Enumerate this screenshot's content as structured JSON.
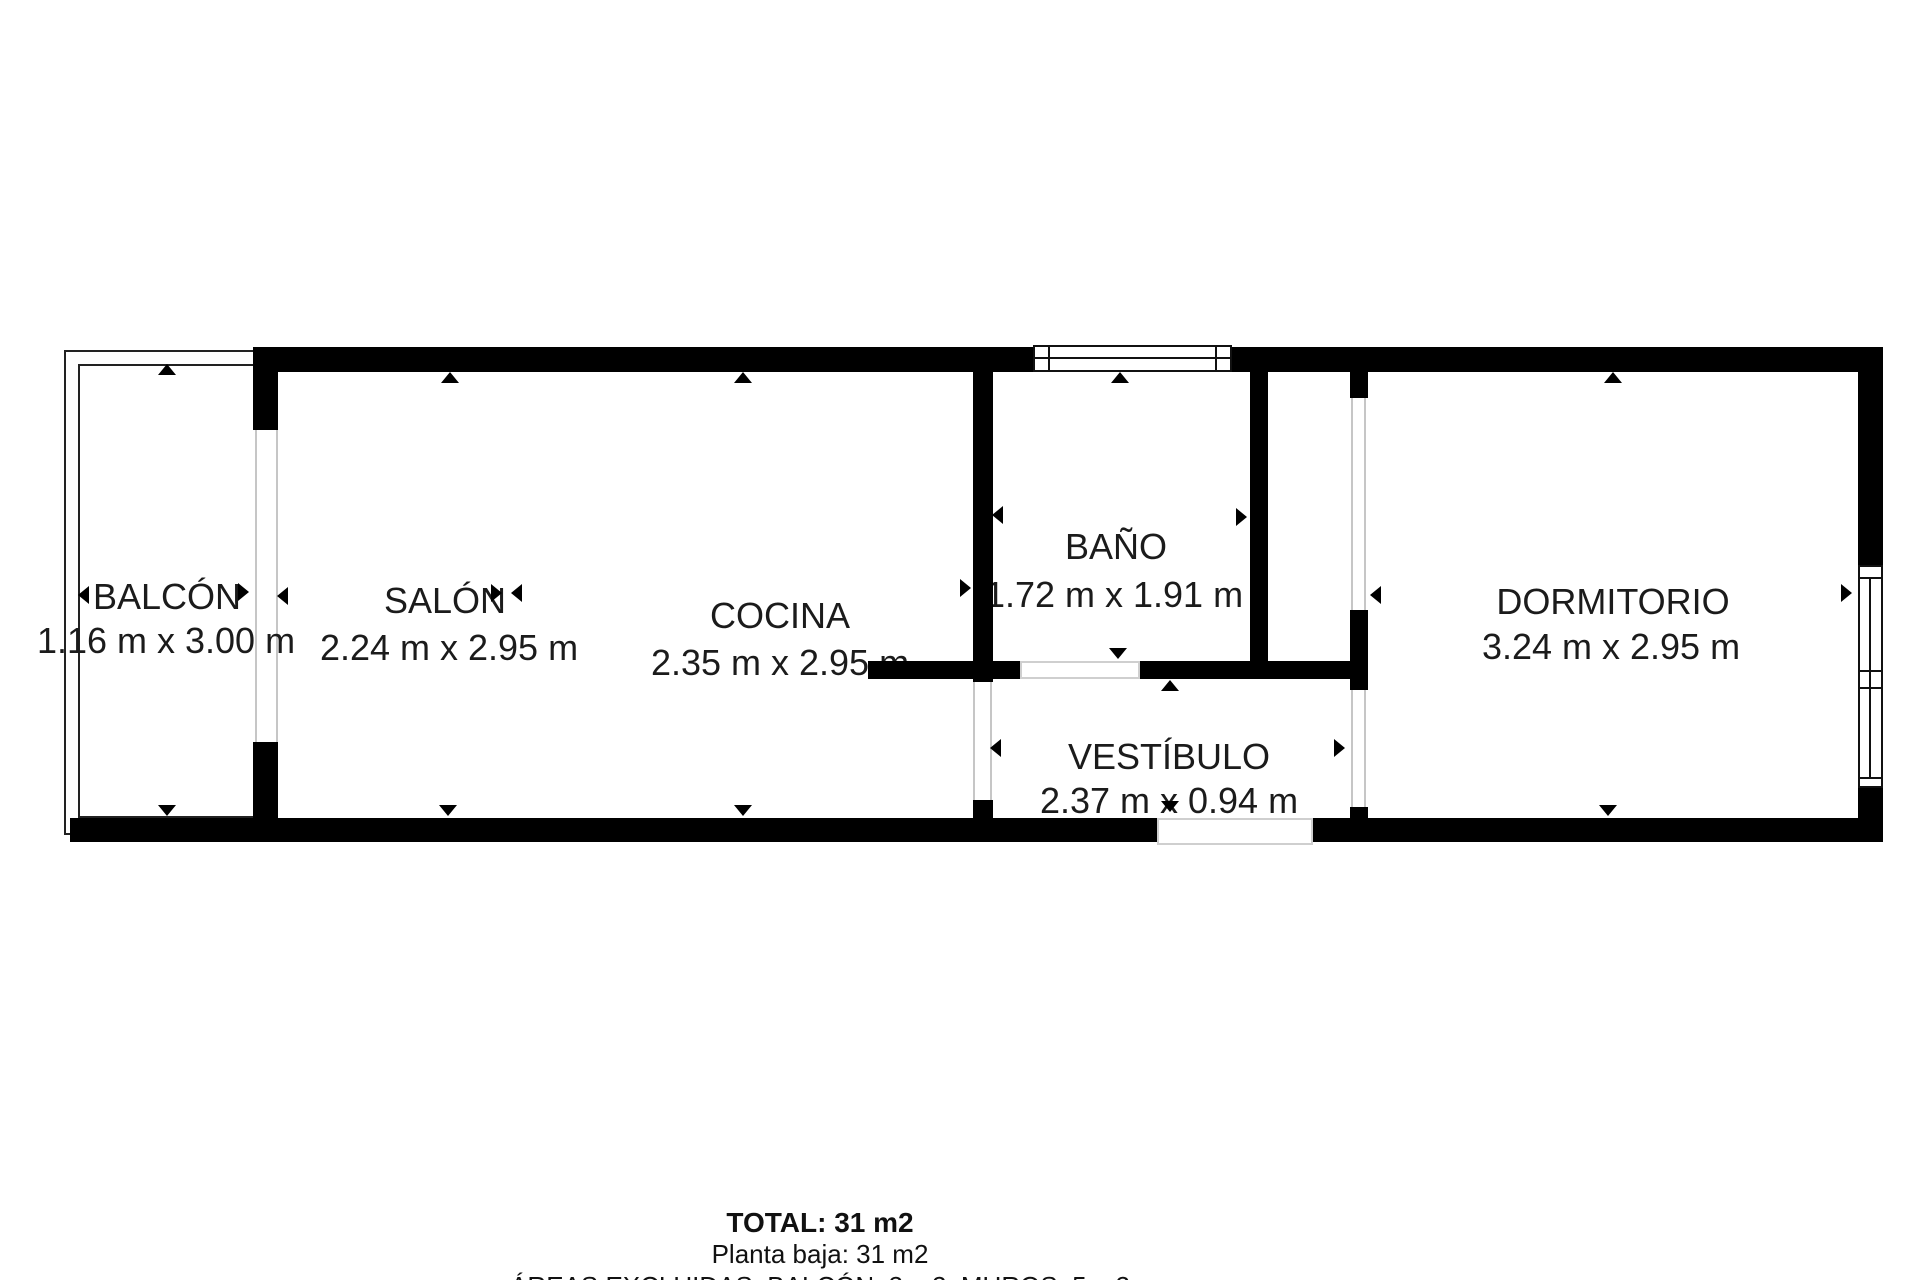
{
  "rooms": [
    {
      "id": "balcon",
      "name": "BALCÓN",
      "dimensions": "1.16 m x 3.00 m"
    },
    {
      "id": "salon",
      "name": "SALÓN",
      "dimensions": "2.24 m x 2.95 m"
    },
    {
      "id": "cocina",
      "name": "COCINA",
      "dimensions": "2.35 m x 2.95 m"
    },
    {
      "id": "bano",
      "name": "BAÑO",
      "dimensions": "1.72 m x 1.91 m"
    },
    {
      "id": "vestibulo",
      "name": "VESTÍBULO",
      "dimensions": "2.37 m x 0.94 m"
    },
    {
      "id": "dormitorio",
      "name": "DORMITORIO",
      "dimensions": "3.24 m x 2.95 m"
    }
  ],
  "summary": {
    "total": "TOTAL: 31 m2",
    "floor": "Planta baja: 31 m2",
    "excluded": "ÁREAS EXCLUIDAS: BALCÓN: 3 m2, MUROS: 5 m2"
  },
  "colors": {
    "wall": "#000000",
    "outline": "#222222",
    "opening_line": "#c6c6c6",
    "text": "#1b1b1b",
    "background": "#ffffff"
  }
}
